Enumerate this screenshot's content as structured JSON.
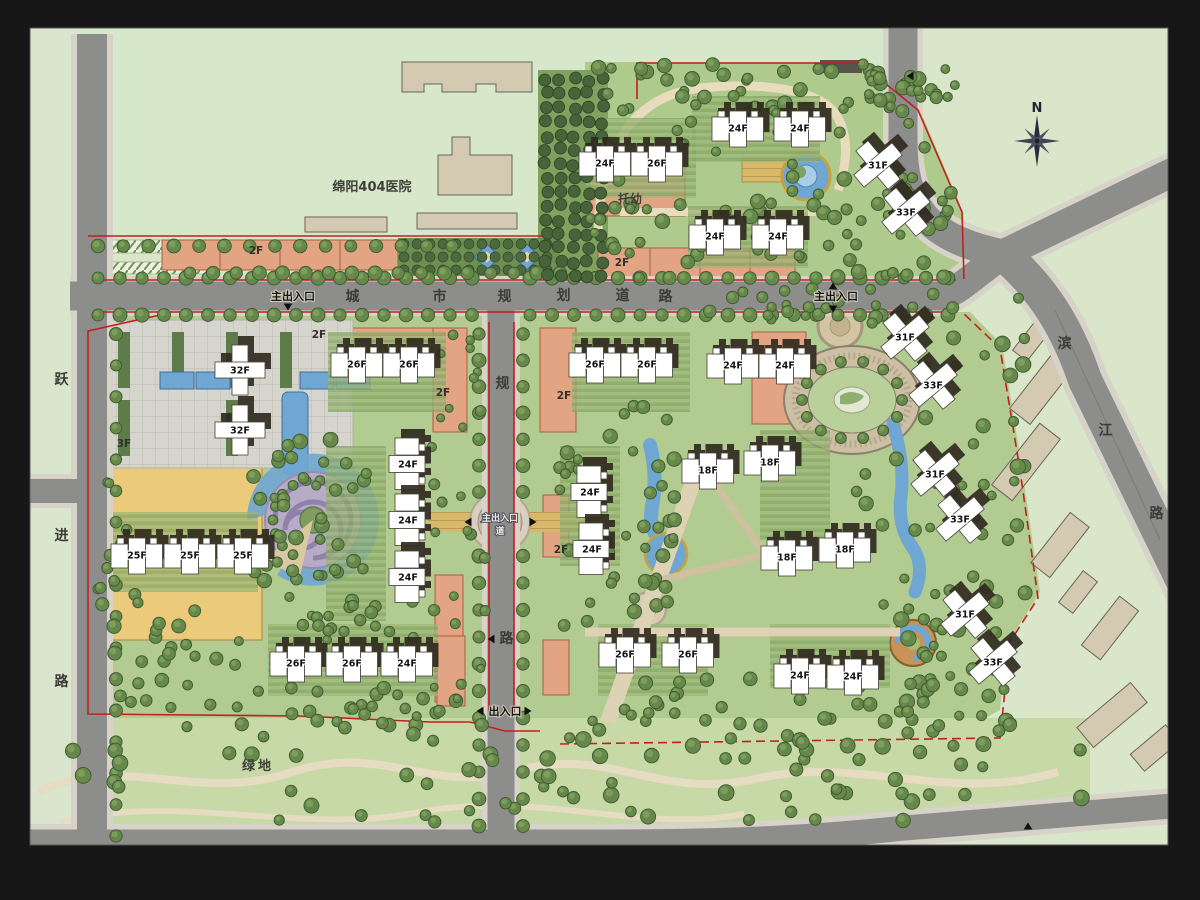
{
  "plan_type": "residential-master-plan",
  "compass": {
    "label": "N",
    "x": 1037,
    "y": 109,
    "cx": 1037,
    "cy": 141
  },
  "colors": {
    "frame": "#171717",
    "context_green": "#d9e6c9",
    "site_green": "#b2cb91",
    "road_gray": "#8d8d8b",
    "road_casing": "#d8d3c8",
    "boundary_red": "#c2201d",
    "water_blue": "#6fa7d2",
    "building_white": "#ffffff",
    "shadow_brown": "#2f281e",
    "podium_salmon": "#e2a482",
    "podium_yellow": "#ecca7c",
    "pavement_tan": "#ddd0b2",
    "tree_green": "#5d8245"
  },
  "roads": {
    "horizontal_name": "城市规划道路",
    "vertical_name": "规划道路",
    "left_name": "跃进路",
    "right_name": "滨江路"
  },
  "road_name_chars": [
    {
      "ch": "城",
      "x": 353,
      "y": 301
    },
    {
      "ch": "市",
      "x": 440,
      "y": 301
    },
    {
      "ch": "规",
      "x": 505,
      "y": 301
    },
    {
      "ch": "划",
      "x": 564,
      "y": 300
    },
    {
      "ch": "道",
      "x": 623,
      "y": 300
    },
    {
      "ch": "路",
      "x": 666,
      "y": 301
    },
    {
      "ch": "规",
      "x": 503,
      "y": 388
    },
    {
      "ch": "路",
      "x": 507,
      "y": 643
    },
    {
      "ch": "跃",
      "x": 62,
      "y": 384
    },
    {
      "ch": "进",
      "x": 62,
      "y": 540
    },
    {
      "ch": "路",
      "x": 62,
      "y": 686
    },
    {
      "ch": "滨",
      "x": 1065,
      "y": 348
    },
    {
      "ch": "江",
      "x": 1106,
      "y": 435
    },
    {
      "ch": "路",
      "x": 1157,
      "y": 518
    }
  ],
  "entrances": [
    {
      "text": "主出入口",
      "x": 293,
      "y": 300,
      "arrows": [
        {
          "x": 288,
          "y": 307,
          "dir": "down"
        }
      ]
    },
    {
      "text": "主出入口",
      "x": 836,
      "y": 300,
      "arrows": [
        {
          "x": 833,
          "y": 286,
          "dir": "up"
        },
        {
          "x": 833,
          "y": 309,
          "dir": "down"
        }
      ]
    },
    {
      "text": "出入口",
      "x": 505,
      "y": 715,
      "arrows": [
        {
          "x": 480,
          "y": 711,
          "dir": "left"
        },
        {
          "x": 528,
          "y": 711,
          "dir": "right"
        }
      ]
    }
  ],
  "roundabout": {
    "line1": "主出入口",
    "line2": "道",
    "x": 500,
    "y": 521,
    "cx": 500,
    "cy": 522
  },
  "extra_arrows": [
    {
      "x": 491,
      "y": 639,
      "dir": "left"
    },
    {
      "x": 468,
      "y": 522,
      "dir": "left"
    },
    {
      "x": 533,
      "y": 522,
      "dir": "right"
    },
    {
      "x": 1028,
      "y": 826,
      "dir": "up"
    },
    {
      "x": 910,
      "y": 76,
      "dir": "left"
    }
  ],
  "areas": {
    "hospital": {
      "text": "绵阳404医院",
      "x": 372,
      "y": 191
    },
    "nursery": {
      "text": "托幼",
      "x": 630,
      "y": 203
    },
    "greenbelt": {
      "text": "绿地",
      "x": 258,
      "y": 770
    }
  },
  "podium_labels": [
    {
      "text": "2F",
      "x": 256,
      "y": 254
    },
    {
      "text": "2F",
      "x": 622,
      "y": 266
    },
    {
      "text": "2F",
      "x": 319,
      "y": 338
    },
    {
      "text": "2F",
      "x": 443,
      "y": 396
    },
    {
      "text": "2F",
      "x": 564,
      "y": 399
    },
    {
      "text": "2F",
      "x": 561,
      "y": 553
    },
    {
      "text": "3F",
      "x": 124,
      "y": 447
    }
  ],
  "buildings": [
    {
      "label": "24F",
      "x": 605,
      "y": 163
    },
    {
      "label": "26F",
      "x": 657,
      "y": 163
    },
    {
      "label": "24F",
      "x": 738,
      "y": 128
    },
    {
      "label": "24F",
      "x": 800,
      "y": 128
    },
    {
      "label": "24F",
      "x": 715,
      "y": 236
    },
    {
      "label": "24F",
      "x": 778,
      "y": 236
    },
    {
      "label": "31F",
      "x": 878,
      "y": 165,
      "rot": -40,
      "type": "point"
    },
    {
      "label": "33F",
      "x": 906,
      "y": 212,
      "rot": -40,
      "type": "point"
    },
    {
      "label": "32F",
      "x": 240,
      "y": 370,
      "type": "point"
    },
    {
      "label": "32F",
      "x": 240,
      "y": 430,
      "type": "point"
    },
    {
      "label": "25F",
      "x": 137,
      "y": 555
    },
    {
      "label": "25F",
      "x": 190,
      "y": 555
    },
    {
      "label": "25F",
      "x": 243,
      "y": 555
    },
    {
      "label": "26F",
      "x": 357,
      "y": 364
    },
    {
      "label": "26F",
      "x": 409,
      "y": 364
    },
    {
      "label": "24F",
      "x": 408,
      "y": 464,
      "rot": 90
    },
    {
      "label": "24F",
      "x": 408,
      "y": 520,
      "rot": 90
    },
    {
      "label": "24F",
      "x": 408,
      "y": 577,
      "rot": 90
    },
    {
      "label": "26F",
      "x": 296,
      "y": 663
    },
    {
      "label": "26F",
      "x": 352,
      "y": 663
    },
    {
      "label": "24F",
      "x": 407,
      "y": 663
    },
    {
      "label": "26F",
      "x": 595,
      "y": 364
    },
    {
      "label": "26F",
      "x": 647,
      "y": 364
    },
    {
      "label": "24F",
      "x": 733,
      "y": 365
    },
    {
      "label": "24F",
      "x": 785,
      "y": 365
    },
    {
      "label": "24F",
      "x": 590,
      "y": 492,
      "rot": 90
    },
    {
      "label": "24F",
      "x": 592,
      "y": 549,
      "rot": 90
    },
    {
      "label": "18F",
      "x": 708,
      "y": 470
    },
    {
      "label": "18F",
      "x": 770,
      "y": 462
    },
    {
      "label": "18F",
      "x": 787,
      "y": 557
    },
    {
      "label": "18F",
      "x": 845,
      "y": 549
    },
    {
      "label": "26F",
      "x": 625,
      "y": 654
    },
    {
      "label": "26F",
      "x": 688,
      "y": 654
    },
    {
      "label": "24F",
      "x": 800,
      "y": 675
    },
    {
      "label": "24F",
      "x": 853,
      "y": 676
    },
    {
      "label": "31F",
      "x": 905,
      "y": 337,
      "rot": -40,
      "type": "point"
    },
    {
      "label": "33F",
      "x": 933,
      "y": 385,
      "rot": -40,
      "type": "point"
    },
    {
      "label": "31F",
      "x": 935,
      "y": 474,
      "rot": -40,
      "type": "point"
    },
    {
      "label": "33F",
      "x": 960,
      "y": 519,
      "rot": -40,
      "type": "point"
    },
    {
      "label": "31F",
      "x": 965,
      "y": 614,
      "rot": -40,
      "type": "point"
    },
    {
      "label": "33F",
      "x": 993,
      "y": 662,
      "rot": -40,
      "type": "point"
    }
  ]
}
